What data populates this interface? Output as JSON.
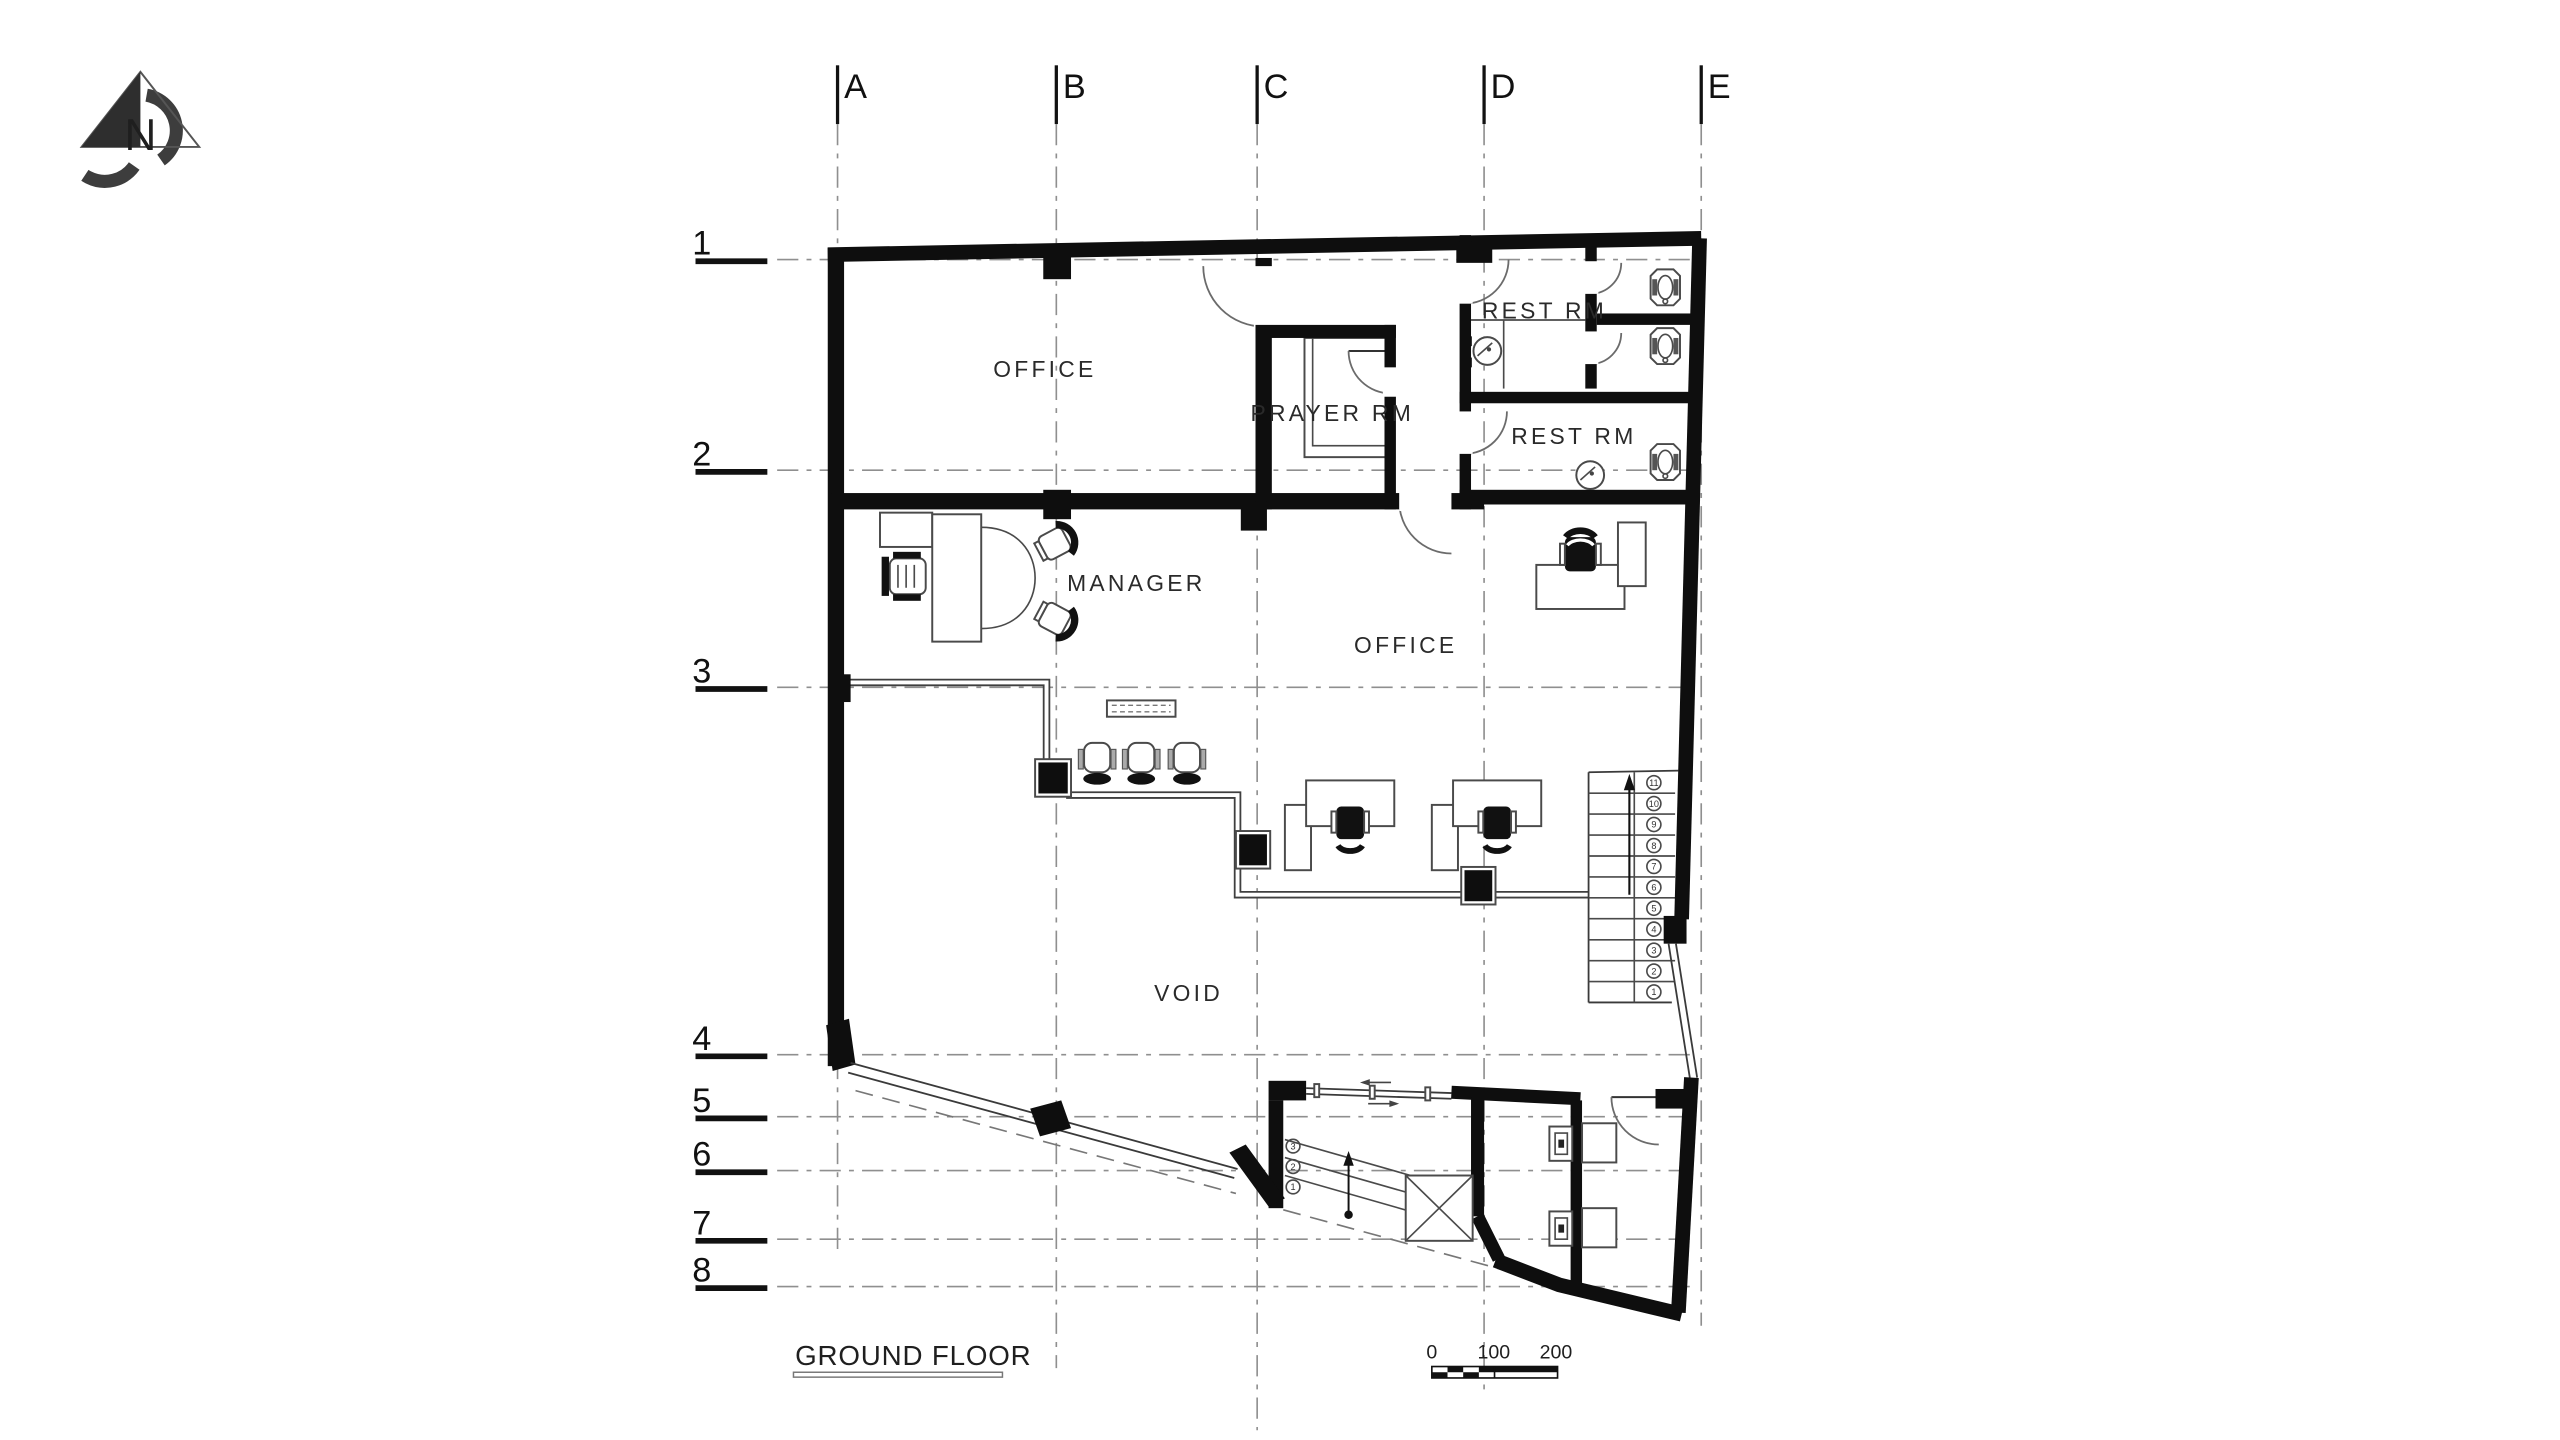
{
  "title": {
    "label": "GROUND FLOOR"
  },
  "north": {
    "label": "N"
  },
  "grid": {
    "columns": [
      "A",
      "B",
      "C",
      "D",
      "E"
    ],
    "rows": [
      "1",
      "2",
      "3",
      "4",
      "5",
      "6",
      "7",
      "8"
    ]
  },
  "rooms": {
    "office_top": "OFFICE",
    "prayer": "PRAYER RM",
    "rest_top": "REST RM",
    "rest_bottom": "REST RM",
    "manager": "MANAGER",
    "office_main": "OFFICE",
    "void": "VOID"
  },
  "stairs": {
    "steps": [
      "1",
      "2",
      "3",
      "4",
      "5",
      "6",
      "7",
      "8",
      "9",
      "10",
      "11"
    ]
  },
  "entry": {
    "steps": [
      "3",
      "2",
      "1"
    ]
  },
  "scale_bar": {
    "labels": [
      "0",
      "100",
      "200"
    ]
  },
  "colors": {
    "wall": "#0e0e0e",
    "grid_line": "#8f8f8f",
    "furniture_line": "#4a4a4a",
    "text": "#1f1f1f",
    "background": "#ffffff"
  }
}
